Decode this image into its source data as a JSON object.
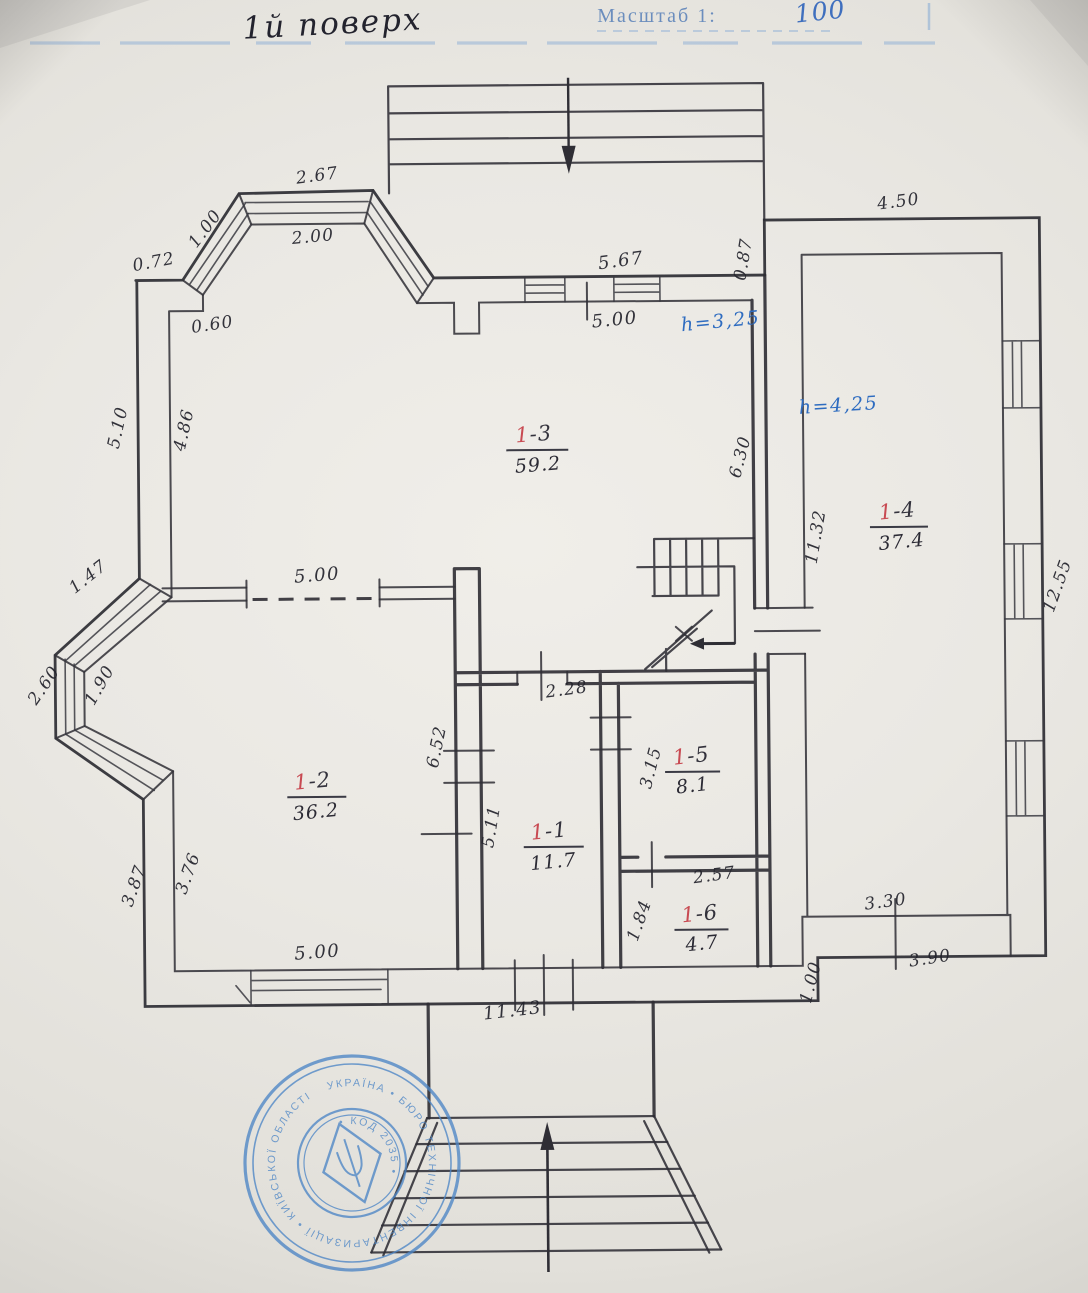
{
  "header": {
    "floor_title": "1й поверх",
    "scale_label": "Масштаб 1:",
    "scale_value": "100"
  },
  "annotations": {
    "height_main": "h=3,25",
    "height_annex": "h=4,25"
  },
  "rooms": {
    "r13": {
      "num": "1",
      "suffix": "-3",
      "area": "59.2"
    },
    "r12": {
      "num": "1",
      "suffix": "-2",
      "area": "36.2"
    },
    "r11": {
      "num": "1",
      "suffix": "-1",
      "area": "11.7"
    },
    "r15": {
      "num": "1",
      "suffix": "-5",
      "area": "8.1"
    },
    "r16": {
      "num": "1",
      "suffix": "-6",
      "area": "4.7"
    },
    "r14": {
      "num": "1",
      "suffix": "-4",
      "area": "37.4"
    }
  },
  "dimensions": {
    "d072": "0.72",
    "d100a": "1.00",
    "d267": "2.67",
    "d200": "2.00",
    "d060": "0.60",
    "d510": "5.10",
    "d486": "4.86",
    "d567": "5.67",
    "d500top": "5.00",
    "d087": "0.87",
    "d450": "4.50",
    "d630": "6.30",
    "d1132": "11.32",
    "d1255": "12.55",
    "d147": "1.47",
    "d260": "2.60",
    "d190": "1.90",
    "d500mid": "5.00",
    "d652": "6.52",
    "d511": "5.11",
    "d228": "2.28",
    "d315": "3.15",
    "d257": "2.57",
    "d184": "1.84",
    "d376": "3.76",
    "d387": "3.87",
    "d500bot": "5.00",
    "d1143": "11.43",
    "d100b": "1.00",
    "d330": "3.30",
    "d390": "3.90"
  },
  "stamp": {
    "ring_outer": "УКРАЇНА • БЮРО ТЕХНІЧНОЇ ІНВЕНТАРИЗАЦІЇ • КИЇВСЬКОЇ ОБЛАСТІ",
    "ring_inner": "• КОД 2035 •"
  },
  "colors": {
    "ink": "#23232c",
    "room_red": "#c84a52",
    "note_blue": "#2e6cc0",
    "stamp_blue": "#4d86c6",
    "paper": "#eae8e3"
  }
}
